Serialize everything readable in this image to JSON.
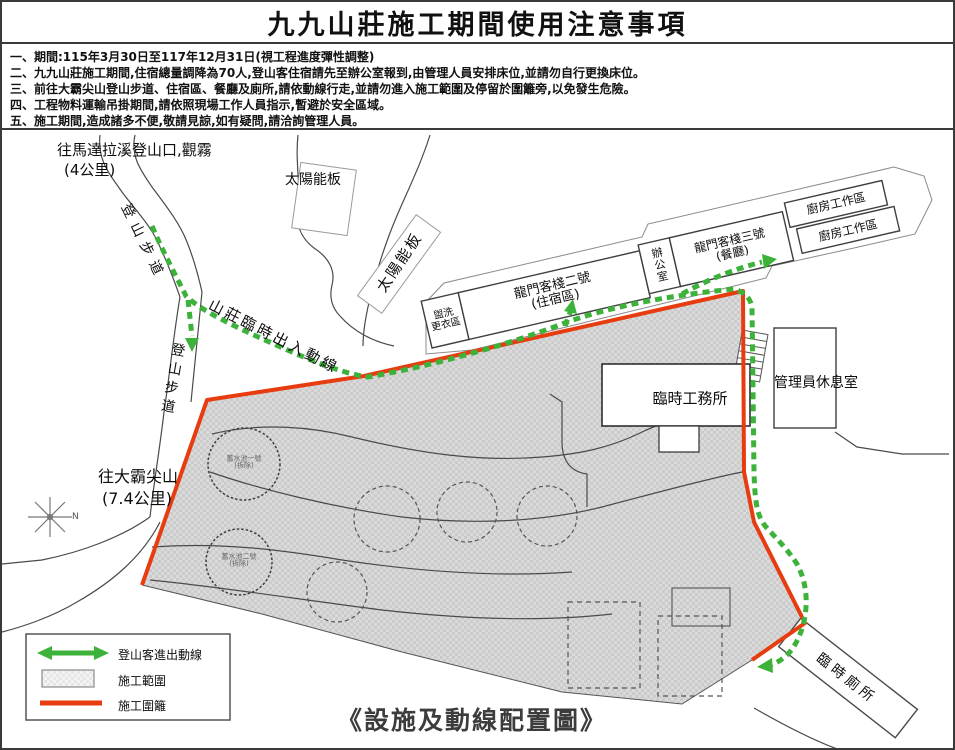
{
  "header": {
    "title": "九九山莊施工期間使用注意事項",
    "notes": [
      "一、期間:115年3月30日至117年12月31日(視工程進度彈性調整)",
      "二、九九山莊施工期間,住宿總量調降為70人,登山客住宿請先至辦公室報到,由管理人員安排床位,並請勿自行更換床位。",
      "三、前往大霸尖山登山步道、住宿區、餐廳及廁所,請依動線行走,並請勿進入施工範圍及停留於圍籬旁,以免發生危險。",
      "四、工程物料運輸吊掛期間,請依照現場工作人員指示,暫避於安全區域。",
      "五、施工期間,造成諸多不便,敬請見諒,如有疑問,請洽詢管理人員。"
    ]
  },
  "map": {
    "labels": {
      "trailhead_dest": "往馬達拉溪登山口,觀霧",
      "trailhead_dist": "(4公里)",
      "trail_upper": "登山步道",
      "trail_lower": "登山步道",
      "dabajian_dest": "往大霸尖山",
      "dabajian_dist": "(7.4公里)",
      "route_label": "山莊臨時出入動線",
      "solar_1": "太陽能板",
      "solar_2": "太陽能板",
      "north": "N"
    },
    "buildings": {
      "wash": {
        "line1": "盥洗",
        "line2": "更衣區"
      },
      "inn2": {
        "line1": "龍門客棧二號",
        "line2": "(住宿區)"
      },
      "office": {
        "label": "辦公室"
      },
      "inn3": {
        "line1": "龍門客棧三號",
        "line2": "(餐廳)"
      },
      "kitchen1": {
        "label": "廚房工作區"
      },
      "kitchen2": {
        "label": "廚房工作區"
      },
      "manager": {
        "label": "管理員休息室"
      },
      "site_office": {
        "label": "臨時工務所"
      },
      "toilet": {
        "label": "臨時廁所"
      }
    },
    "tanks": {
      "tank1": {
        "line1": "蓄水池一號",
        "line2": "(拆除)"
      },
      "tank2": {
        "line1": "蓄水池二號",
        "line2": "(拆除)"
      }
    },
    "legend": {
      "items": [
        {
          "label": "登山客進出動線"
        },
        {
          "label": "施工範圍"
        },
        {
          "label": "施工圍籬"
        }
      ]
    },
    "caption": "《設施及動線配置圖》"
  },
  "colors": {
    "route_green": "#3db23a",
    "fence_red": "#e73c0f",
    "hatch_gray": "#d9d9d9"
  }
}
